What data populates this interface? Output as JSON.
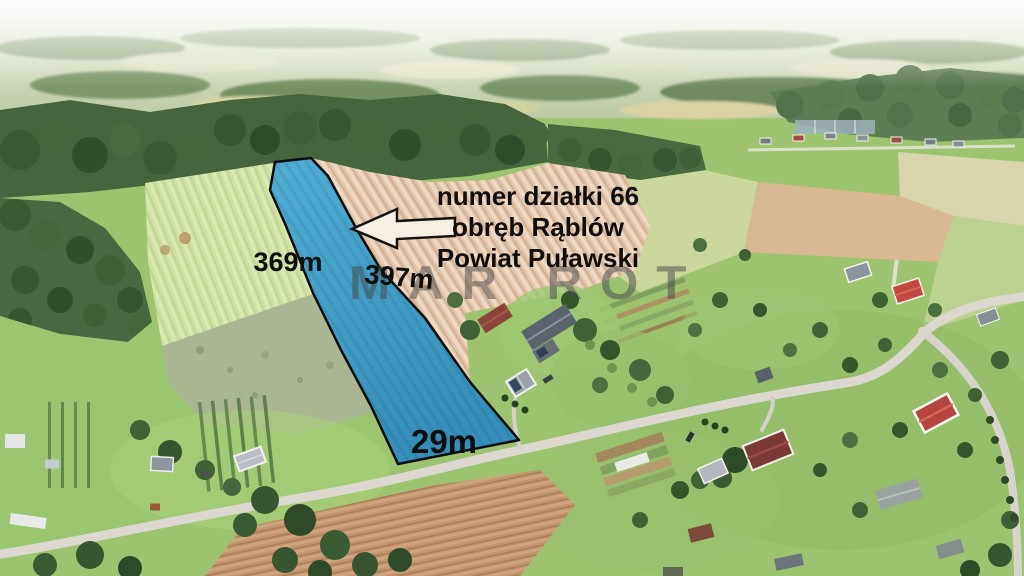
{
  "overlay": {
    "plot_info": {
      "lines": [
        "numer działki 66",
        "obręb Rąblów",
        "Powiat Puławski"
      ]
    },
    "dimensions": {
      "left_side": "369m",
      "right_side": "397m",
      "bottom_side": "29m"
    },
    "watermark": "MAR ROT"
  },
  "colors": {
    "label_text": "#0e0e0e",
    "watermark_text": "rgba(72,72,72,0.52)",
    "parcel_fill_top": "#3aa7d6",
    "parcel_fill_bottom": "#1d86b9",
    "parcel_outline": "#0d0d0d",
    "arrow_fill": "#f6efe3",
    "arrow_outline": "#131313"
  }
}
